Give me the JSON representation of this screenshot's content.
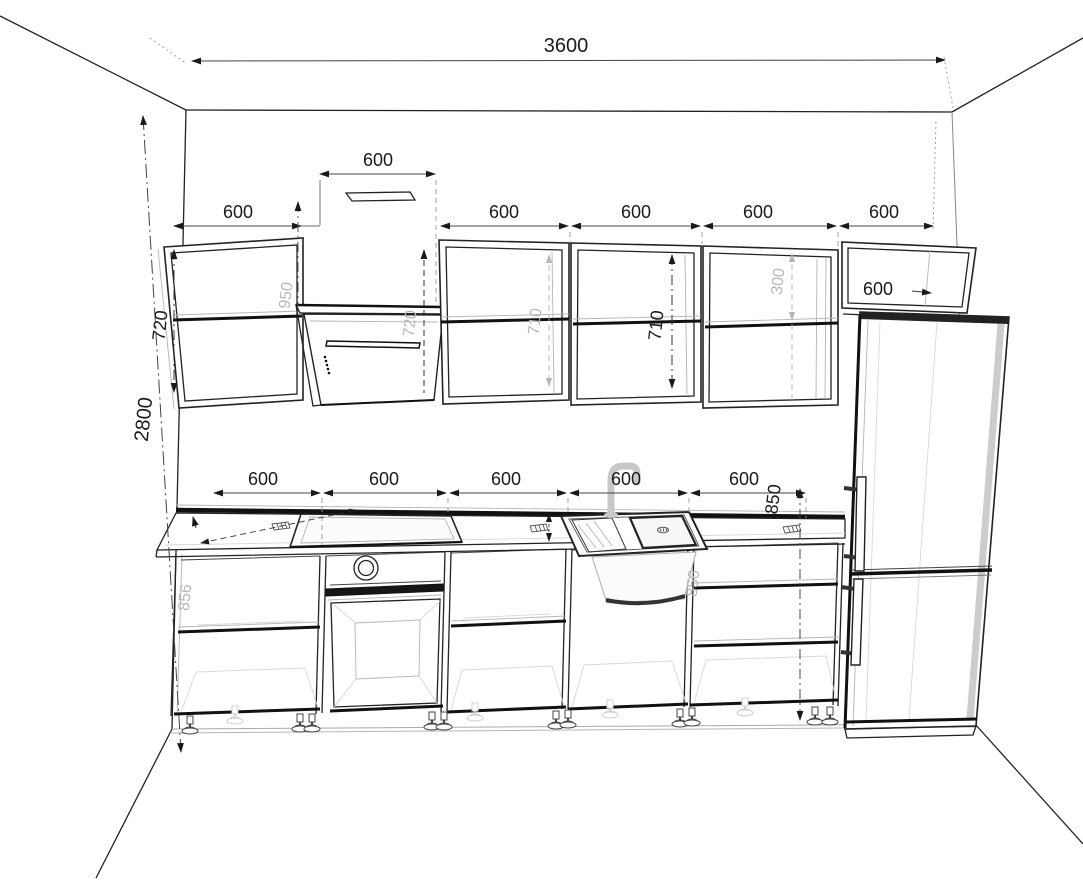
{
  "drawing_type": "kitchen-elevation-wireframe",
  "colors": {
    "line": "#1a1a1a",
    "faint_label": "#b8b8b8",
    "background": "#ffffff"
  },
  "dims": {
    "room_width": "3600",
    "room_height": "2800",
    "upper1_width": "600",
    "hood_width": "600",
    "upper2_width": "600",
    "upper3_width": "600",
    "upper4_width": "600",
    "fridge_cab_width": "600",
    "fridge_cab_depth": "600",
    "fridge_cab_shelf": "300",
    "upper1_height": "720",
    "hood_panel_height": "720",
    "hood_clearance": "950",
    "upper2_inner_height": "710",
    "upper3_inner_height": "710",
    "base1_width": "600",
    "base2_width": "600",
    "base3_width": "600",
    "base4_width": "600",
    "base5_width": "600",
    "counter_height": "850",
    "base1_carcass_height": "856",
    "sink_carcass_height": "856"
  }
}
